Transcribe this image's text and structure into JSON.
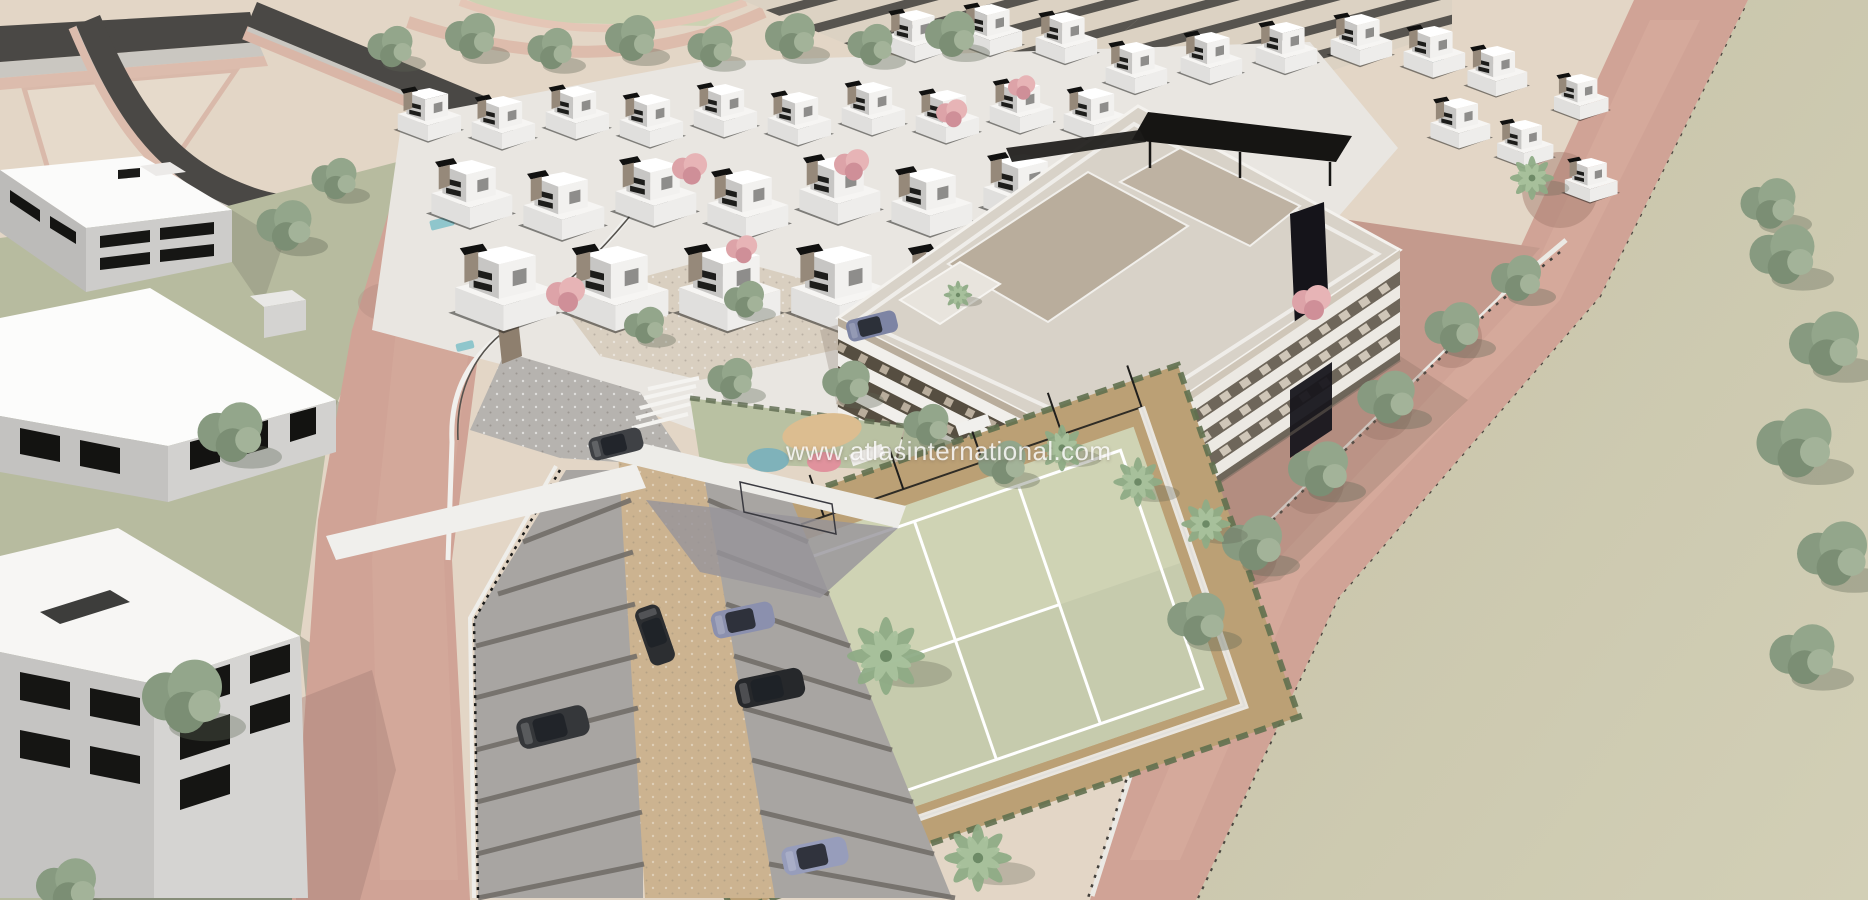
{
  "image": {
    "type": "architectural-aerial-render",
    "title": "Aerial 3D render of a residential development with villas, an apartment block, padel court, parking and landscaped roads",
    "watermark_text": "www.atlasinternational.com"
  },
  "scene": {
    "elements": [
      "villa-cluster",
      "apartment-building",
      "padel-court",
      "parking-lot",
      "playground",
      "palm-trees",
      "tree-rows",
      "asphalt-roads",
      "pink-roads",
      "left-apartment-buildings",
      "open-field"
    ],
    "counts": {
      "parked_cars": 6,
      "moving_cars": 1,
      "padel_courts": 1
    },
    "colors": {
      "terrain": "#e3d6c6",
      "asphalt": "#4a4845",
      "sidewalk": "#cac7c1",
      "curb_pink": "#dcbcad",
      "road_pink": "#d0a396",
      "field_olive": "#cac6ac",
      "lawn_green": "#b7bb9f",
      "villa_white": "#f5f4f2",
      "facade_gray": "#c7c6c4",
      "window_dark": "#1c1c1a",
      "stone_brown": "#96897a",
      "apartment_taupe": "#b9ad9c",
      "band_white": "#f1efeb",
      "core_black": "#15141a",
      "court_green": "#cfd3b4",
      "court_line": "#ffffff",
      "fence_dark": "#201f1d",
      "surround_tan": "#bba075",
      "hedge_green": "#61704f",
      "parking_gray": "#a8a5a2",
      "divider_gray": "#6f6b66",
      "paver_beige": "#ccb390",
      "playground_green": "#b9c1a2",
      "circle_blue": "#7fb2ba",
      "circle_pink": "#e0929d",
      "sand_tan": "#dcbd90",
      "tree_green": "#93a68b",
      "palm_green": "#8fac86",
      "ramp_white": "#f0efec",
      "car_dark": "#2c2e31",
      "car_blue": "#8b90ae",
      "pool_teal": "#8fc6cc"
    }
  }
}
